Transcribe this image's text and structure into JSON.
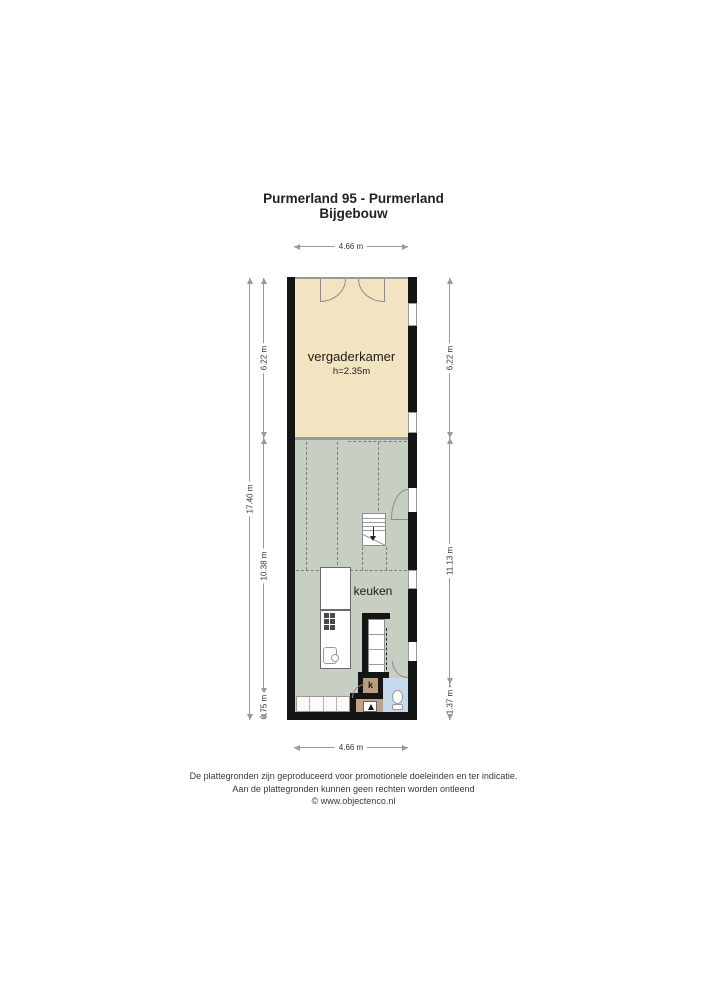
{
  "title": {
    "line1": "Purmerland 95 - Purmerland",
    "line2": "Bijgebouw"
  },
  "rooms": {
    "vergaderkamer": {
      "label": "vergaderkamer",
      "height_note": "h=2.35m"
    },
    "keuken": {
      "label": "keuken"
    },
    "closet": {
      "label": "k"
    }
  },
  "dimensions": {
    "top": "4.66 m",
    "bottom": "4.66 m",
    "left_total": "17.40 m",
    "left_upper": "6.22 m",
    "left_middle": "10.38 m",
    "left_lower": "0.75 m",
    "right_upper": "6.22 m",
    "right_middle": "11.13 m",
    "right_lower": "1.37 m"
  },
  "footer": {
    "line1": "De plattegronden zijn geproduceerd voor promotionele doeleinden en ter indicatie.",
    "line2": "Aan de plattegronden kunnen geen rechten worden ontleend",
    "line3": "© www.objectenco.nl"
  },
  "colors": {
    "wall": "#151515",
    "room_vergaderkamer": "#f2e4c1",
    "room_keuken": "#c7cfc3",
    "toilet_floor": "#c4d9ec",
    "hall_floor": "#bda287",
    "closet_floor": "#b89e7d",
    "dimension_line": "#999999"
  }
}
